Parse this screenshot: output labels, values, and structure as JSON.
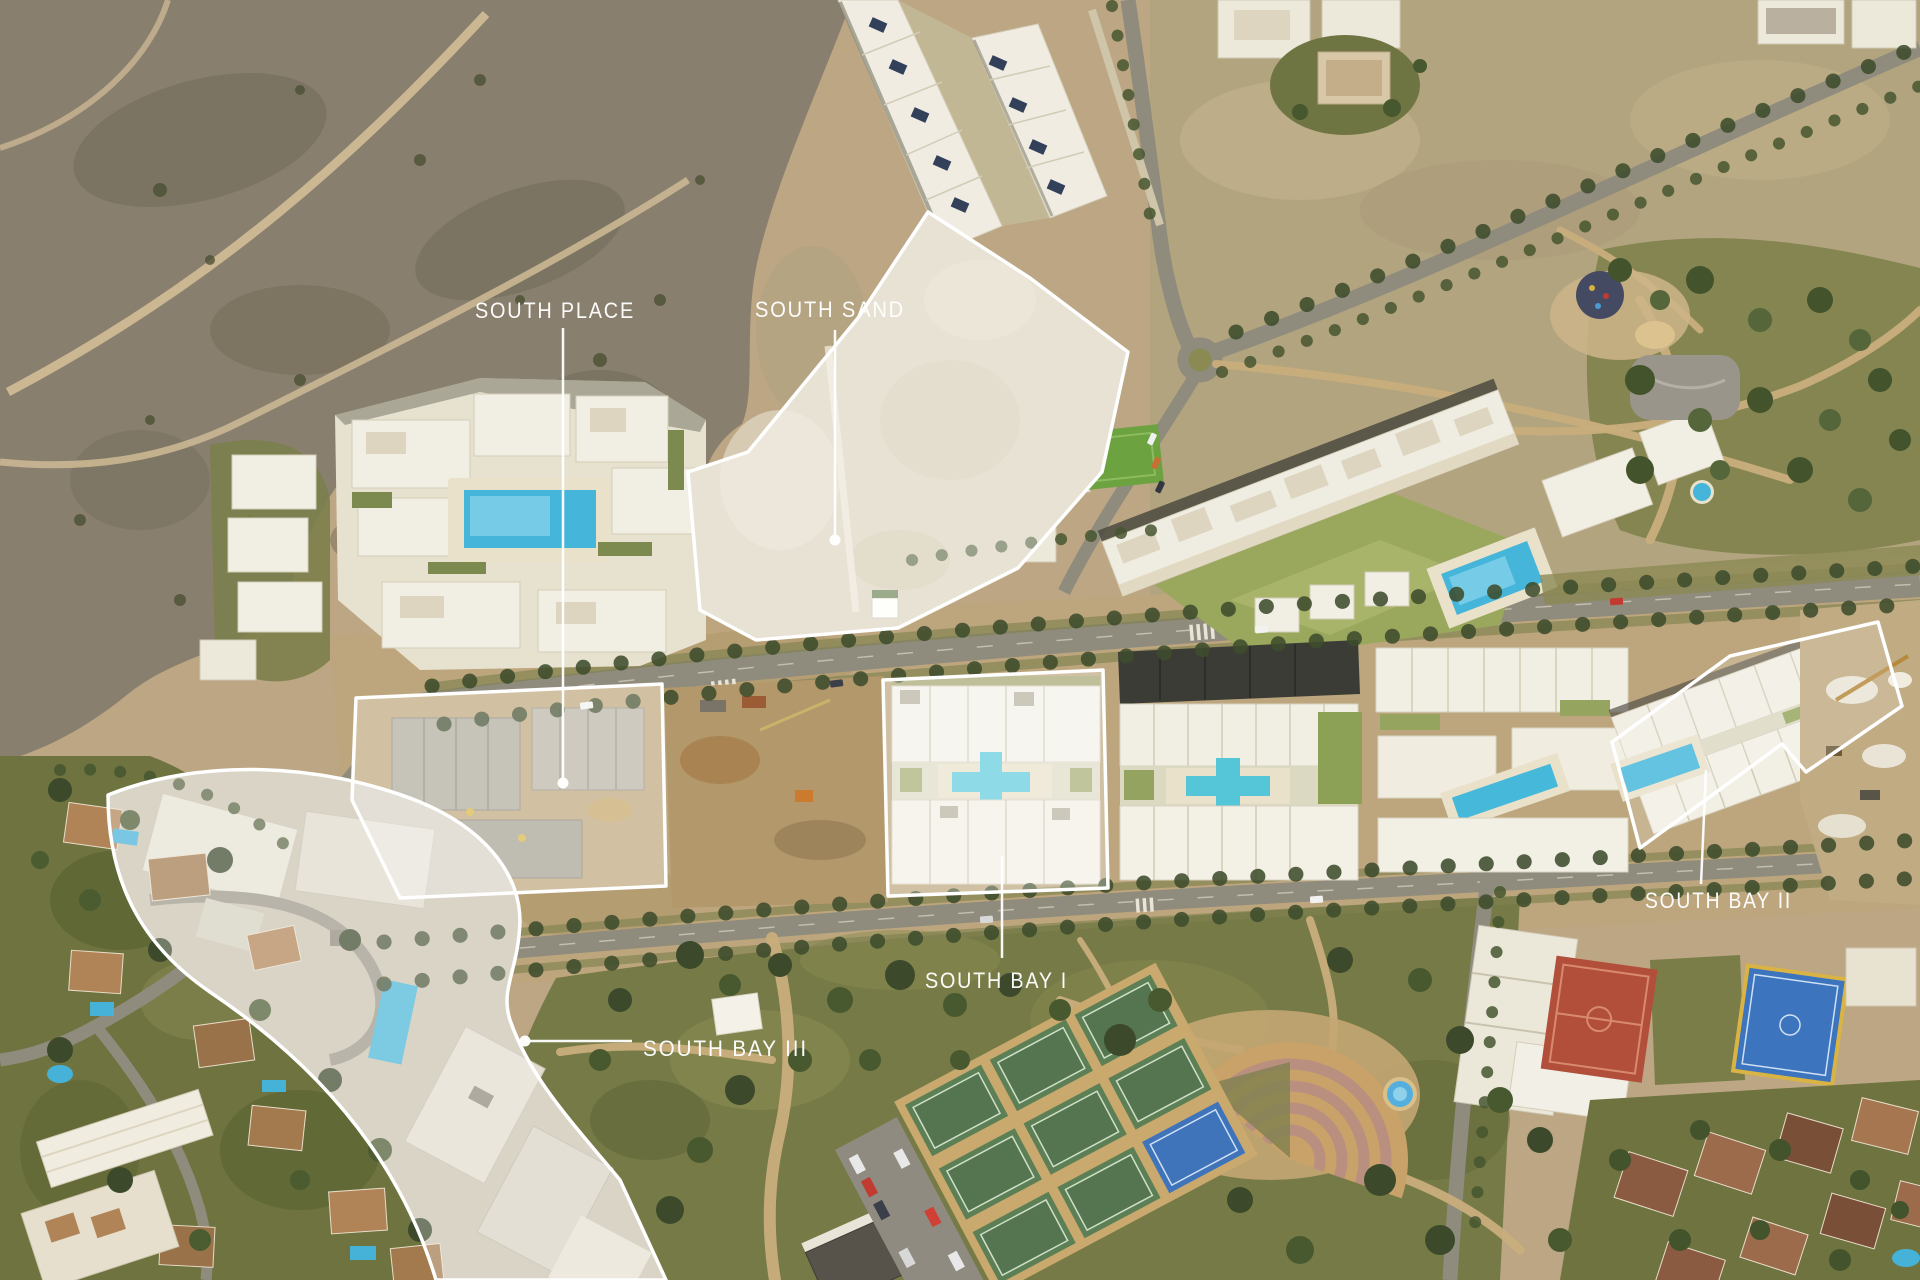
{
  "labels": {
    "south_place": "SOUTH PLACE",
    "south_sand": "SOUTH SAND",
    "south_bay_1": "SOUTH BAY I",
    "south_bay_2": "SOUTH BAY II",
    "south_bay_3": "SOUTH BAY III"
  },
  "colors": {
    "label_text": "#ffffff",
    "parcel_outline": "#ffffff",
    "parcel_fill": "rgba(255,255,255,0.30)",
    "pool_blue": "#45b5da",
    "sports_court_red": "#b24f3a",
    "sports_court_blue": "#3c74bd",
    "court_border_yellow": "#d9b445",
    "vegetation_dark": "#3e4c2c",
    "park_green": "#767a46",
    "scrub_olive": "#897f6e",
    "terrain_tan": "#bca684",
    "road_gray": "#8f8b7d",
    "building_white": "#f1eee4",
    "villa_roof": "#b08457"
  }
}
